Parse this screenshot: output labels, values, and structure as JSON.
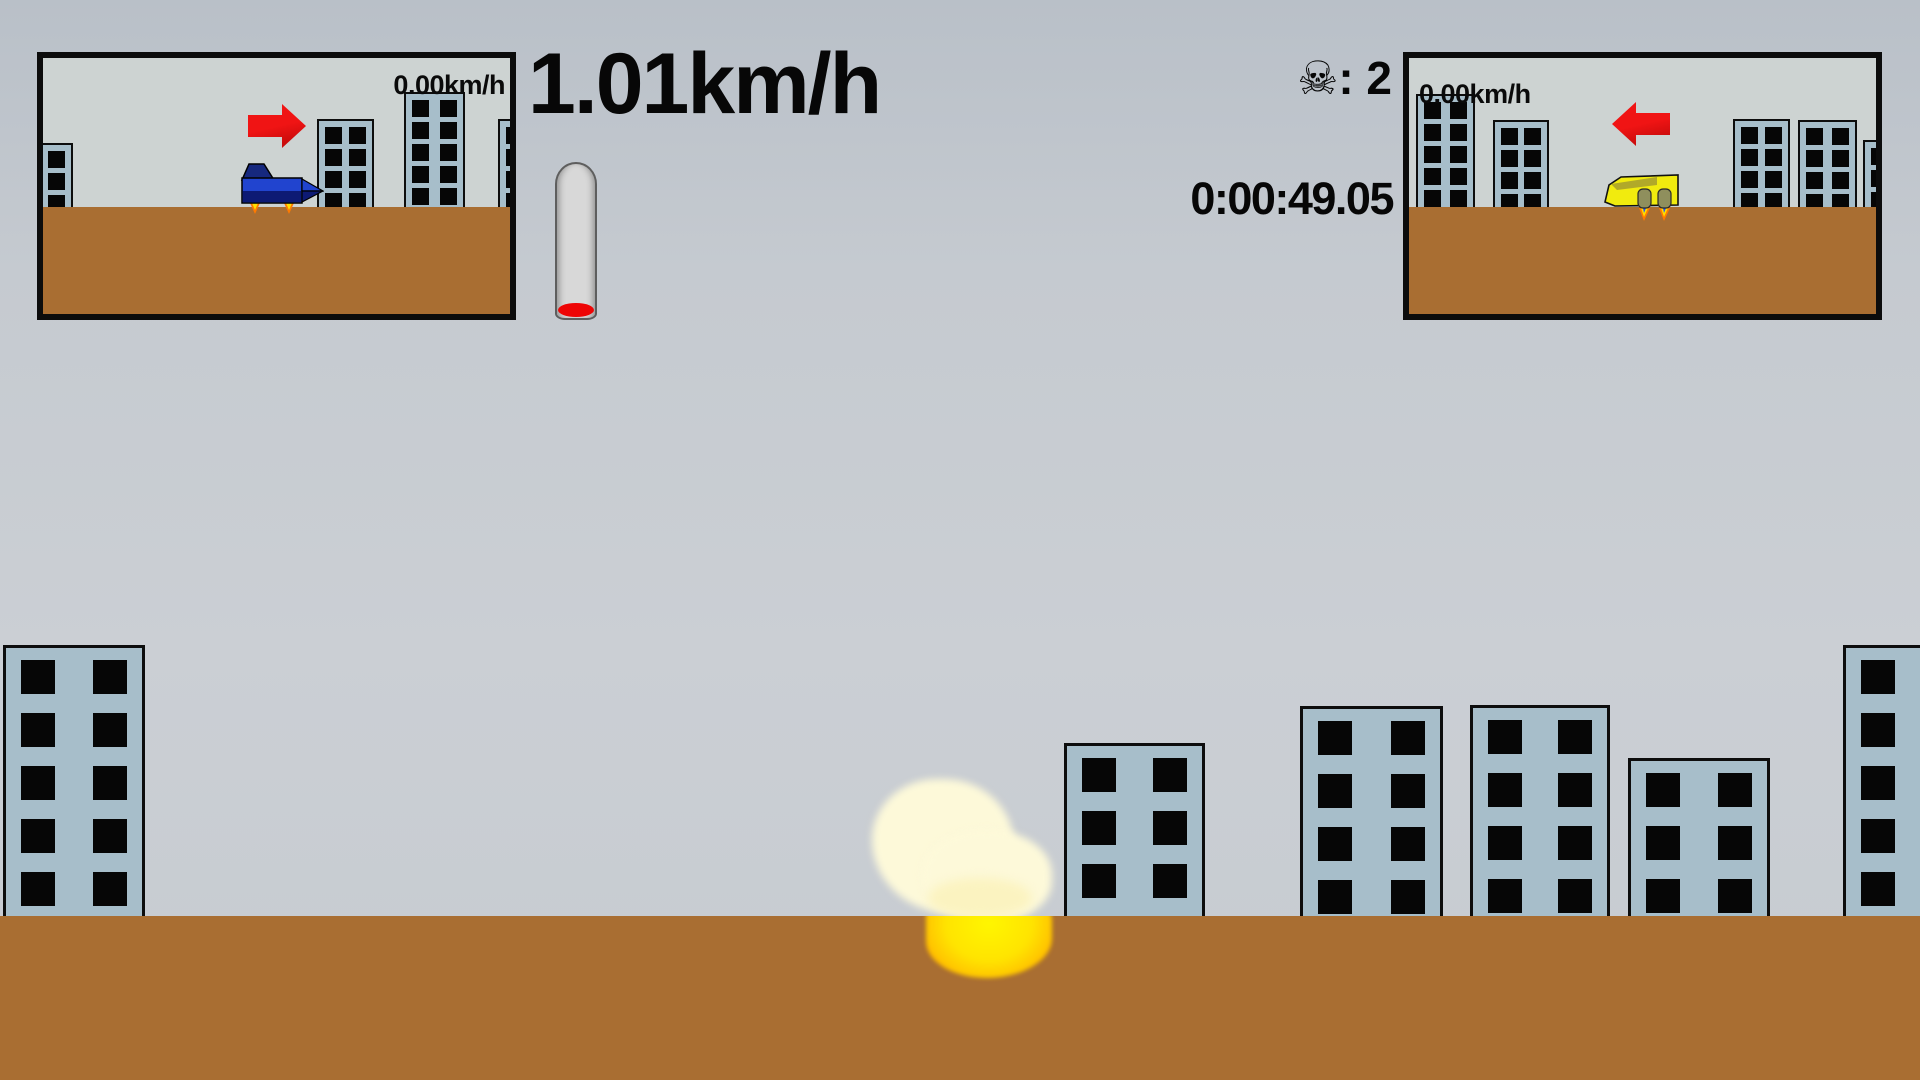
{
  "hud": {
    "main_speed": "1.01km/h",
    "skull_icon": "☠",
    "death_count_text": ": 2",
    "timer": "0:00:49.05",
    "fuel_gauge": {
      "state": "nearly empty",
      "fill_color": "#ee0505",
      "tube_color": "#d8d8d8"
    }
  },
  "minimap_left": {
    "speed_label": "0.00km/h",
    "vehicle": "blue jet facing right",
    "arrow_direction": "right",
    "ground_top": 149,
    "buildings": [
      {
        "x": -30,
        "top": 85,
        "w": 60,
        "rows": 3,
        "cols": 2
      },
      {
        "x": 274,
        "top": 61,
        "w": 57,
        "rows": 4,
        "cols": 2
      },
      {
        "x": 361,
        "top": 34,
        "w": 61,
        "rows": 5,
        "cols": 2
      },
      {
        "x": 455,
        "top": 61,
        "w": 60,
        "rows": 4,
        "cols": 2
      }
    ]
  },
  "minimap_right": {
    "speed_label": "0.00km/h",
    "vehicle": "yellow hovercraft facing left",
    "arrow_direction": "left",
    "ground_top": 149,
    "buildings": [
      {
        "x": 7,
        "top": 36,
        "w": 59,
        "rows": 5,
        "cols": 2
      },
      {
        "x": 84,
        "top": 62,
        "w": 56,
        "rows": 4,
        "cols": 2
      },
      {
        "x": 324,
        "top": 61,
        "w": 57,
        "rows": 4,
        "cols": 2
      },
      {
        "x": 389,
        "top": 62,
        "w": 59,
        "rows": 4,
        "cols": 2
      },
      {
        "x": 454,
        "top": 82,
        "w": 60,
        "rows": 3,
        "cols": 2
      }
    ]
  },
  "scene": {
    "ground_top": 916,
    "explosion": {
      "cx": 962,
      "cy": 875
    },
    "buildings": [
      {
        "x": 3,
        "top": 645,
        "w": 142,
        "rows": 5,
        "cols": 2
      },
      {
        "x": 1064,
        "top": 743,
        "w": 141,
        "rows": 4,
        "cols": 2
      },
      {
        "x": 1300,
        "top": 706,
        "w": 143,
        "rows": 4,
        "cols": 2
      },
      {
        "x": 1470,
        "top": 705,
        "w": 140,
        "rows": 4,
        "cols": 2
      },
      {
        "x": 1628,
        "top": 758,
        "w": 142,
        "rows": 3,
        "cols": 2
      },
      {
        "x": 1843,
        "top": 645,
        "w": 142,
        "rows": 5,
        "cols": 2
      }
    ]
  },
  "colors": {
    "sky": "#c5cad0",
    "minimap_sky": "#cdd3d2",
    "ground": "#a96e32",
    "building_fill": "#a7beca",
    "window": "#060606",
    "arrow_red": "#ee1111",
    "jet_blue": "#2144cf",
    "jet_navy": "#0d1a74",
    "hover_yellow": "#f1eb0e",
    "explosion_smoke": "#fdf9d9",
    "explosion_fire": "#ffe400",
    "gauge_fill_red": "#ee0505"
  }
}
